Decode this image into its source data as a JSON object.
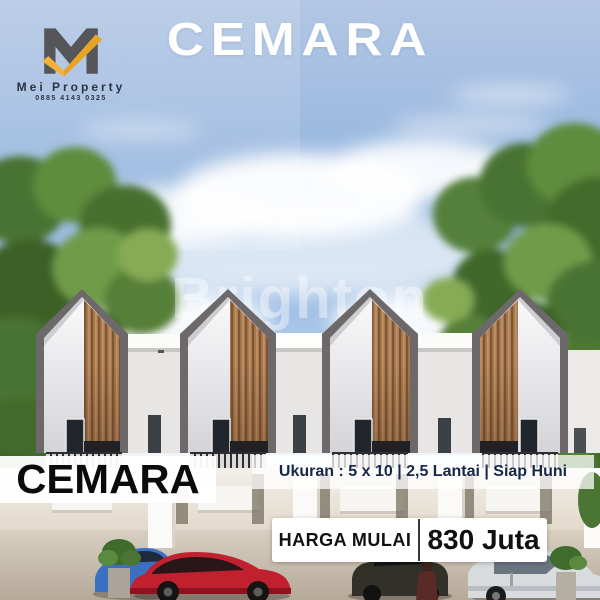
{
  "brand": {
    "name": "Mei Property",
    "phone": "0885 4143 0325"
  },
  "header": {
    "title": "CEMARA"
  },
  "watermark": {
    "text": "Brighton"
  },
  "footer": {
    "project_name": "CEMARA",
    "specs": "Ukuran : 5 x 10 | 2,5 Lantai | Siap Huni",
    "price_label": "HARGA MULAI",
    "price_value": "830 Juta"
  },
  "colors": {
    "logo_gray": "#55565a",
    "accent_yellow": "#f1b13b",
    "navy_text": "#16284a",
    "wood": "#a87a50",
    "roof_frame": "#6d696a"
  }
}
